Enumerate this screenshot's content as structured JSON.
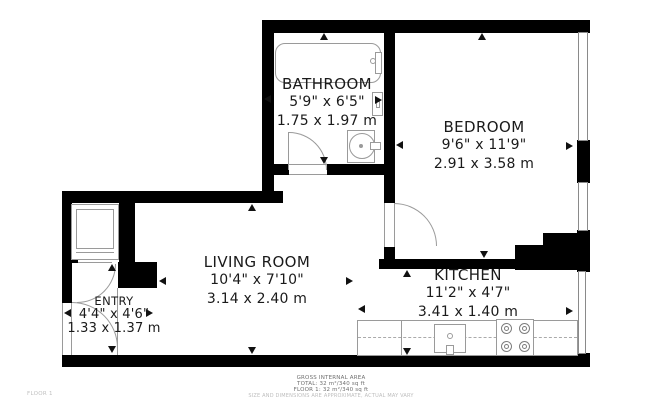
{
  "plan": {
    "type": "floor-plan",
    "floor_corner_label": "FLOOR 1"
  },
  "colors": {
    "wall": "#000000",
    "fixture_line": "#9a9a9a",
    "text": "#1a1a1a",
    "footer_text": "#6f6f6f",
    "footer_light": "#bdbdbd",
    "background": "#ffffff"
  },
  "rooms": [
    {
      "id": "bathroom",
      "name": "BATHROOM",
      "imperial": "5'9\" x 6'5\"",
      "metric": "1.75 x 1.97 m"
    },
    {
      "id": "bedroom",
      "name": "BEDROOM",
      "imperial": "9'6\" x 11'9\"",
      "metric": "2.91 x 3.58 m"
    },
    {
      "id": "living",
      "name": "LIVING ROOM",
      "imperial": "10'4\" x 7'10\"",
      "metric": "3.14 x 2.40 m"
    },
    {
      "id": "kitchen",
      "name": "KITCHEN",
      "imperial": "11'2\" x 4'7\"",
      "metric": "3.41 x 1.40 m"
    },
    {
      "id": "entry",
      "name": "ENTRY",
      "imperial": "4'4\" x 4'6\"",
      "metric": "1.33 x 1.37 m"
    }
  ],
  "fixtures": [
    "bathtub",
    "toilet",
    "wall-cabinet",
    "entry-closet",
    "kitchen-counter",
    "kitchen-sink",
    "stove"
  ],
  "footer": {
    "line1": "GROSS INTERNAL AREA",
    "line2": "TOTAL: 32 m²/340 sq ft",
    "line3": "FLOOR 1: 32 m²/340 sq ft",
    "disclaimer": "SIZE AND DIMENSIONS ARE APPROXIMATE, ACTUAL MAY VARY"
  }
}
